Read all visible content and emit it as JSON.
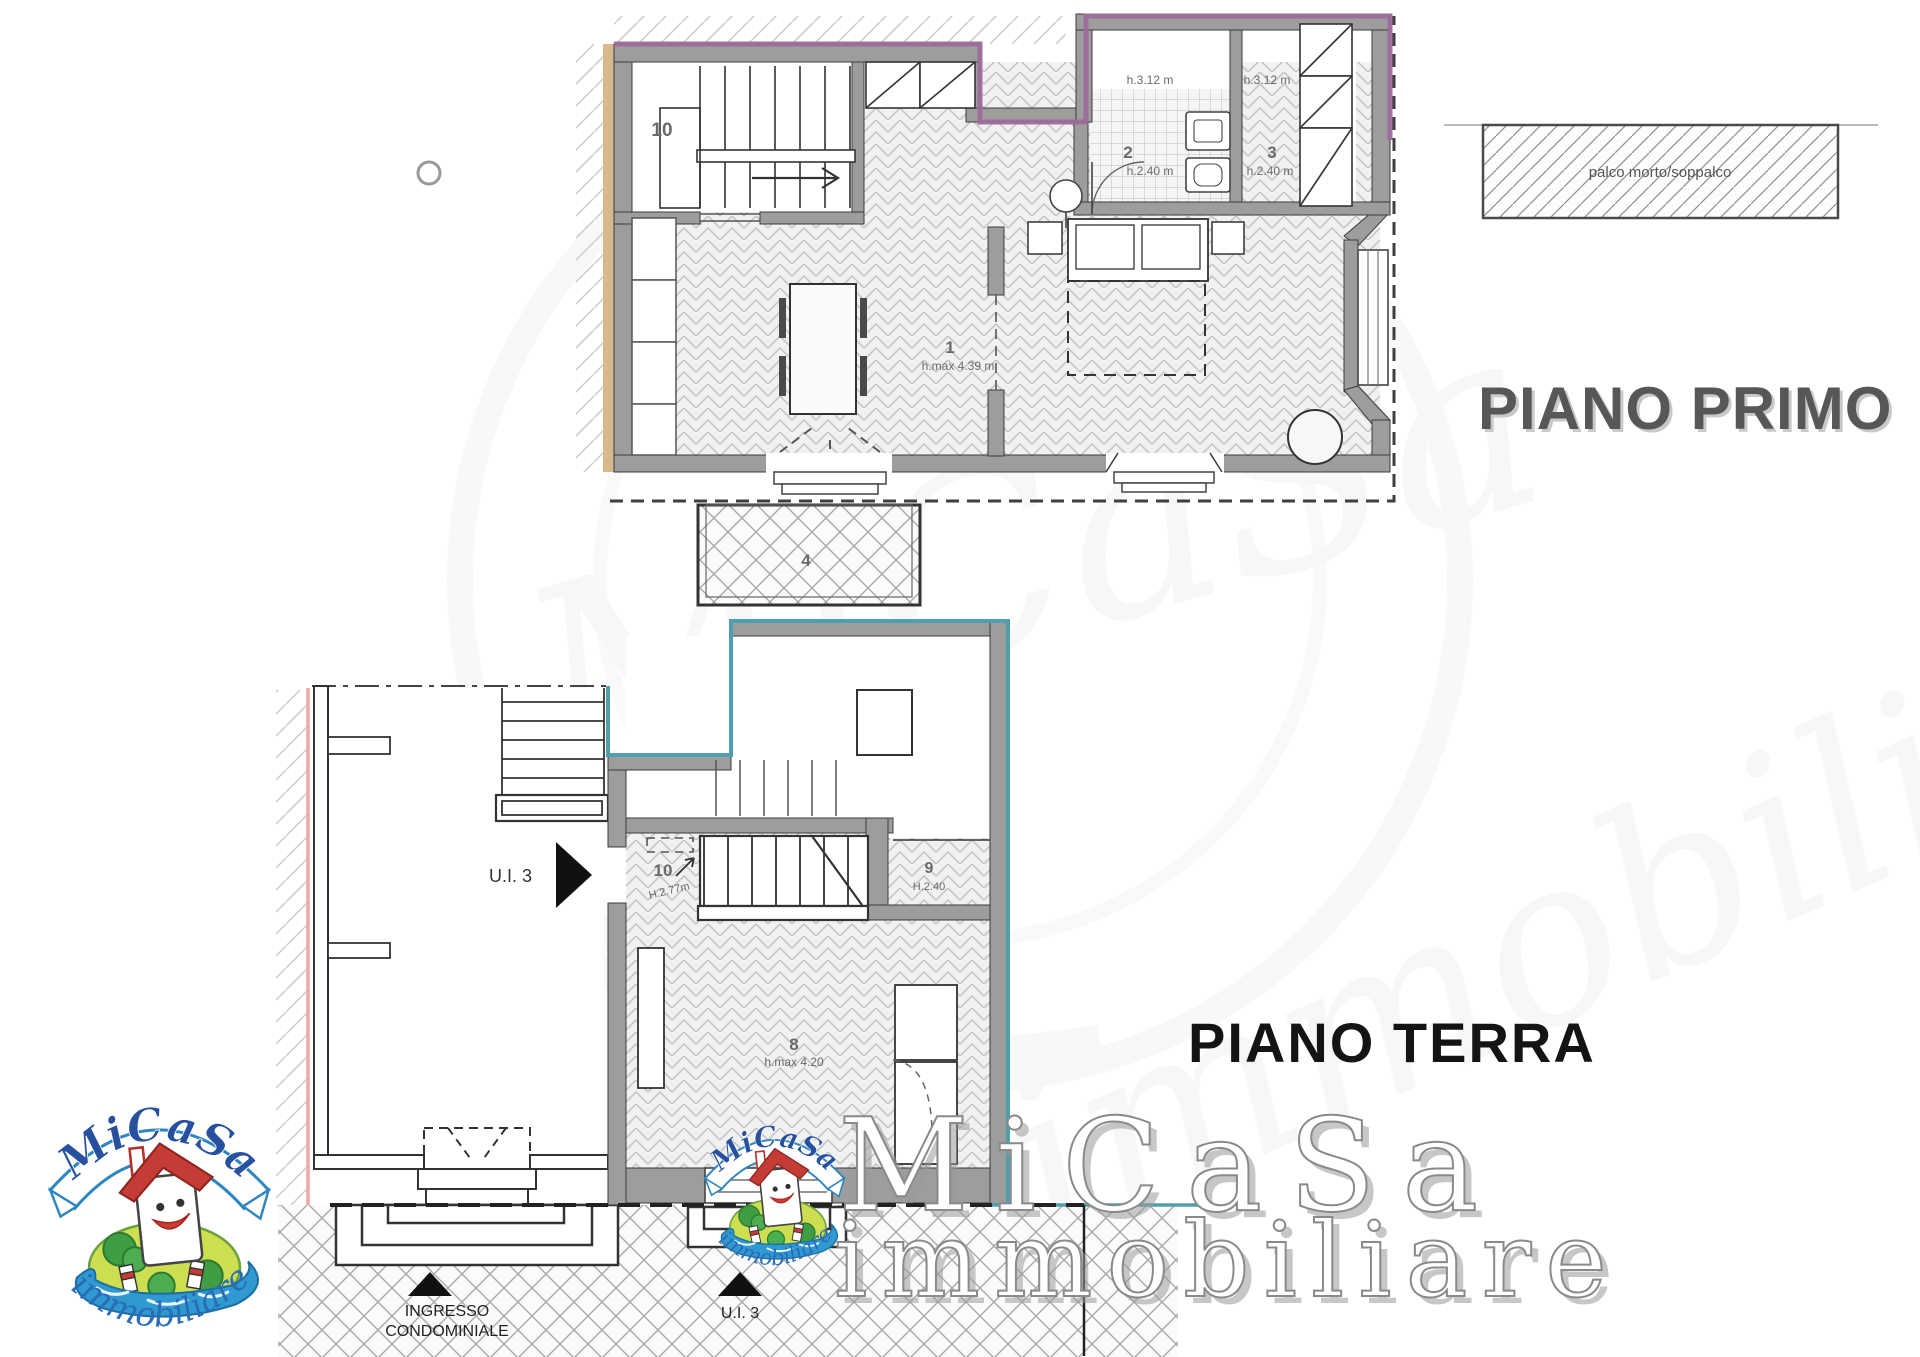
{
  "colors": {
    "purple_outline": "#9c6b9c",
    "teal_outline": "#4f9fad",
    "tan_wall_edge": "#d9b98c",
    "pink_wall_edge": "#f2a6a6",
    "wall_gray": "#9d9d9d"
  },
  "legend": {
    "label": "palco morto/soppalco"
  },
  "first_floor": {
    "title": "PIANO PRIMO",
    "room_stair": {
      "id": "10"
    },
    "room_bath": {
      "id": "2",
      "height": "h.2.40 m",
      "upper_height": "h.3.12 m"
    },
    "room_closet": {
      "id": "3",
      "height": "h.2.40 m",
      "upper_height": "h.3.12 m"
    },
    "room_living": {
      "id": "1",
      "height": "h.max 4.39 m"
    },
    "room_terrace": {
      "id": "4"
    }
  },
  "ground_floor": {
    "title": "PIANO TERRA",
    "unit_label": "U.I. 3",
    "room_entry": {
      "id": "10",
      "height": "H.2.77m"
    },
    "room_closet": {
      "id": "9",
      "height": "H.2.40"
    },
    "room_main": {
      "id": "8",
      "height": "h.max 4.20"
    },
    "entrance_arrow": {
      "line1": "INGRESSO",
      "line2": "CONDOMINIALE"
    },
    "unit_entrance_label": "U.I. 3"
  },
  "logo": {
    "name": "MiCaSa",
    "subtitle": "immobiliare"
  },
  "watermark": {
    "line1": "MiCaSa",
    "line2": "immobiliare"
  }
}
